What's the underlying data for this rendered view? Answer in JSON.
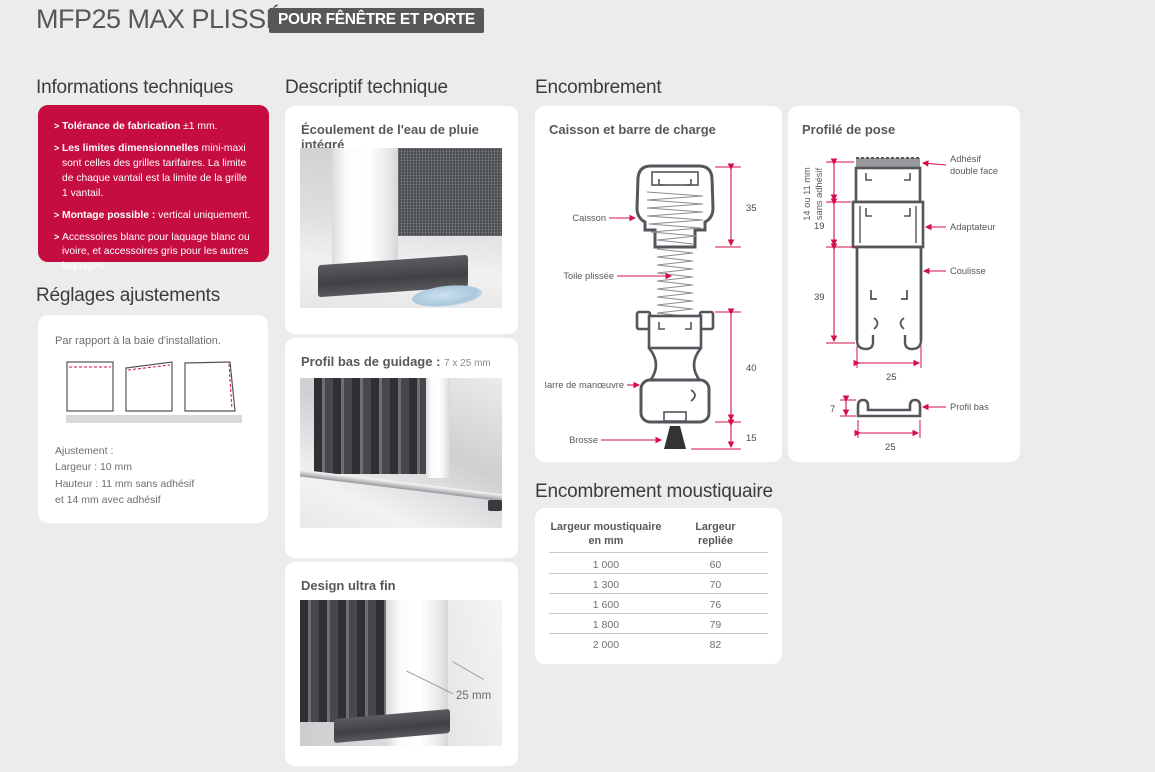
{
  "colors": {
    "accent_red": "#c60d42",
    "badge_bg": "#575756",
    "dim_red": "#d4104a",
    "page_bg": "#ececec"
  },
  "header": {
    "title": "MFP25 MAX PLISSÉ",
    "badge": "POUR FÊNÊTRE ET PORTE"
  },
  "info": {
    "heading": "Informations techniques",
    "bullet": ">",
    "items": [
      {
        "bold": "Tolérance de fabrication",
        "rest": " ±1 mm."
      },
      {
        "bold": "Les limites dimensionnelles",
        "rest": " mini-maxi sont celles des grilles tarifaires. La limite de chaque vantail est la limite de la grille 1 vantail."
      },
      {
        "bold": "Montage possible :",
        "rest": " vertical uniquement."
      },
      {
        "bold": "",
        "rest": "Accessoires blanc pour laquage blanc ou ivoire, et accessoires gris pour les autres laquages."
      }
    ]
  },
  "reglages": {
    "heading": "Réglages ajustements",
    "caption": "Par rapport à la baie d'installation.",
    "lines": [
      "Ajustement :",
      "Largeur : 10 mm",
      "Hauteur : 11 mm sans adhésif",
      "et 14 mm avec adhésif"
    ]
  },
  "descriptif": {
    "heading": "Descriptif technique",
    "card1_title": "Écoulement de l'eau de pluie intégré",
    "card2_title": "Profil bas de guidage :",
    "card2_subtitle": "7 x 25 mm",
    "card3_title": "Design ultra fin",
    "card3_annotation": "25 mm"
  },
  "encombrement": {
    "heading": "Encombrement",
    "caisson": {
      "title": "Caisson et barre de charge",
      "label_caisson": "Caisson",
      "label_toile": "Toile plissée",
      "label_barre": "Barre de manœuvre",
      "label_brosse": "Brosse",
      "dim_35": "35",
      "dim_40": "40",
      "dim_15": "15"
    },
    "profile": {
      "title": "Profilé de pose",
      "label_adhesif_1": "Adhésif",
      "label_adhesif_2": "double face",
      "label_adaptateur": "Adaptateur",
      "label_coulisse": "Coulisse",
      "label_profil_bas": "Profil bas",
      "dim_vert_1": "14 ou 11 mm",
      "dim_vert_2": "sans adhésif",
      "dim_19": "19",
      "dim_39": "39",
      "dim_25_main": "25",
      "dim_7": "7",
      "dim_25_bas": "25"
    }
  },
  "table": {
    "heading": "Encombrement moustiquaire",
    "col1_line1": "Largeur moustiquaire",
    "col1_line2": "en mm",
    "col2_line1": "Largeur",
    "col2_line2": "repliée",
    "rows": [
      [
        "1 000",
        "60"
      ],
      [
        "1 300",
        "70"
      ],
      [
        "1 600",
        "76"
      ],
      [
        "1 800",
        "79"
      ],
      [
        "2 000",
        "82"
      ]
    ]
  }
}
